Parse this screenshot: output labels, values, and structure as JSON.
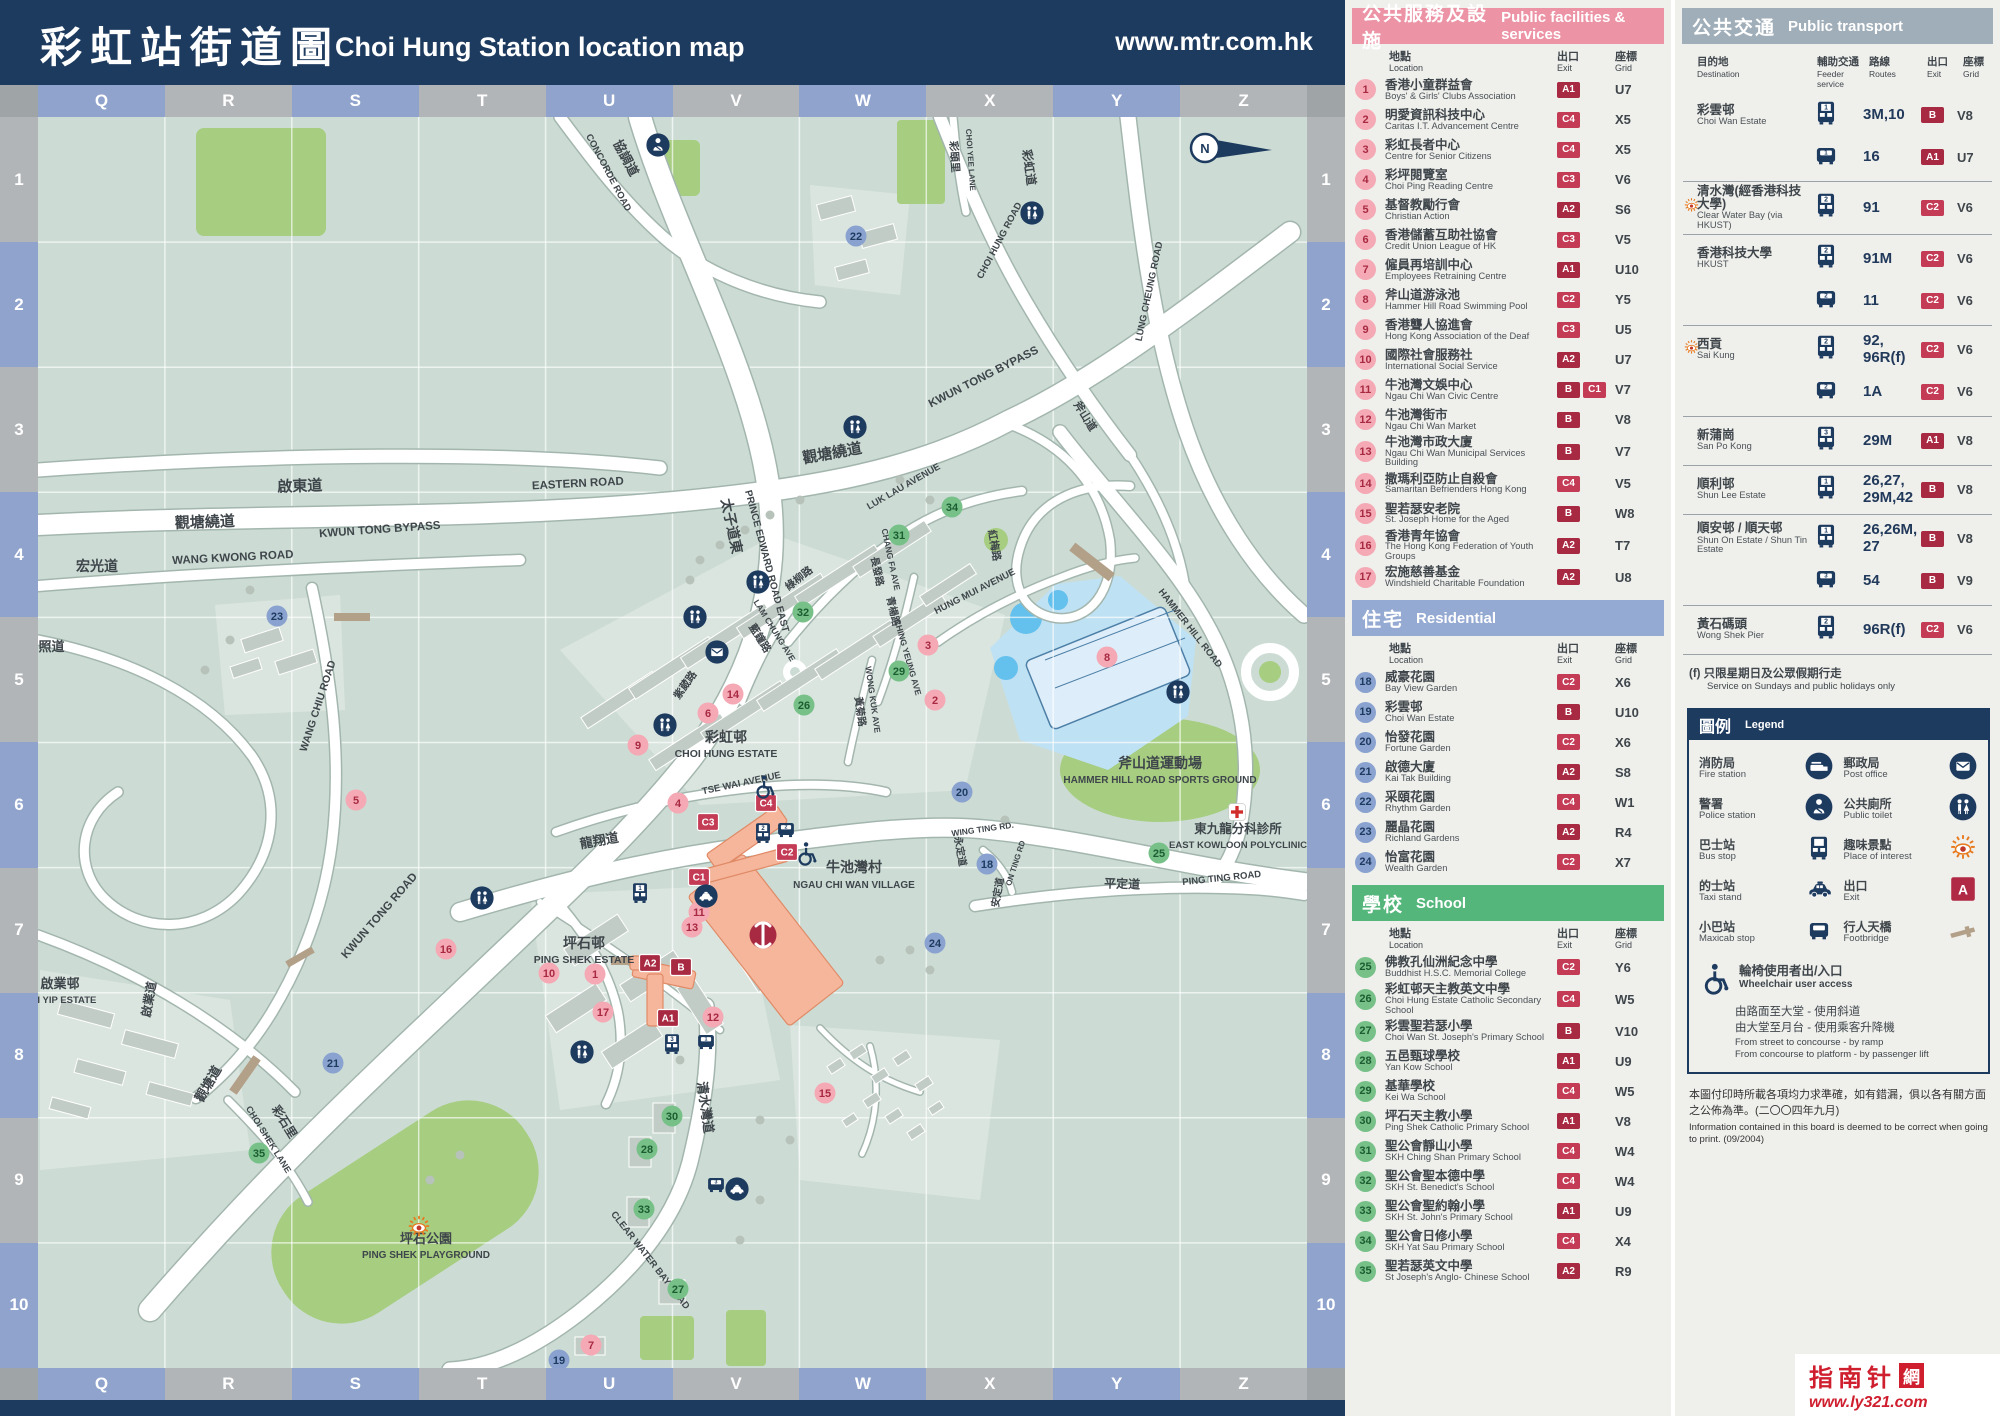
{
  "header": {
    "title_cn": "彩虹站街道圖",
    "title_en": "Choi Hung Station location map",
    "url": "www.mtr.com.hk"
  },
  "grid": {
    "columns": [
      "Q",
      "R",
      "S",
      "T",
      "U",
      "V",
      "W",
      "X",
      "Y",
      "Z"
    ],
    "rows": [
      "1",
      "2",
      "3",
      "4",
      "5",
      "6",
      "7",
      "8",
      "9",
      "10"
    ]
  },
  "colors": {
    "navy": "#1d3a5f",
    "facilities_header": "#ec93a5",
    "residential_header": "#95aad2",
    "school_header": "#55b67c",
    "transport_header": "#a0aeb9",
    "exit_badge": "#a82a42",
    "exit_badge_bright": "#c33b55",
    "marker_pink": "#f4a9b4",
    "marker_blue": "#8aa2cf",
    "marker_green": "#77c189",
    "map_bg": "#ccdcd4",
    "park_green": "#a6cd80",
    "water_blue": "#bfe1f4",
    "station_salmon": "#f5b69c",
    "interest_orange": "#e87a1e"
  },
  "panels": {
    "list_cols": {
      "loc_cn": "地點",
      "loc_en": "Location",
      "exit_cn": "出口",
      "exit_en": "Exit",
      "grid_cn": "座標",
      "grid_en": "Grid"
    },
    "facilities": {
      "title_cn": "公共服務及設施",
      "title_en": "Public facilities & services",
      "items": [
        {
          "num": 1,
          "cn": "香港小童群益會",
          "en": "Boys' & Girls' Clubs Association",
          "exits": [
            "A1"
          ],
          "grid": "U7"
        },
        {
          "num": 2,
          "cn": "明愛資訊科技中心",
          "en": "Caritas I.T. Advancement Centre",
          "exits": [
            "C4"
          ],
          "grid": "X5"
        },
        {
          "num": 3,
          "cn": "彩虹長者中心",
          "en": "Centre for Senior Citizens",
          "exits": [
            "C4"
          ],
          "grid": "X5"
        },
        {
          "num": 4,
          "cn": "彩坪閱覽室",
          "en": "Choi Ping Reading Centre",
          "exits": [
            "C3"
          ],
          "grid": "V6"
        },
        {
          "num": 5,
          "cn": "基督教勵行會",
          "en": "Christian Action",
          "exits": [
            "A2"
          ],
          "grid": "S6"
        },
        {
          "num": 6,
          "cn": "香港儲蓄互助社協會",
          "en": "Credit Union League of HK",
          "exits": [
            "C3"
          ],
          "grid": "V5"
        },
        {
          "num": 7,
          "cn": "僱員再培訓中心",
          "en": "Employees Retraining Centre",
          "exits": [
            "A1"
          ],
          "grid": "U10"
        },
        {
          "num": 8,
          "cn": "斧山道游泳池",
          "en": "Hammer Hill Road Swimming Pool",
          "exits": [
            "C2"
          ],
          "grid": "Y5"
        },
        {
          "num": 9,
          "cn": "香港聾人協進會",
          "en": "Hong Kong Association of the Deaf",
          "exits": [
            "C3"
          ],
          "grid": "U5"
        },
        {
          "num": 10,
          "cn": "國際社會服務社",
          "en": "International Social Service",
          "exits": [
            "A2"
          ],
          "grid": "U7"
        },
        {
          "num": 11,
          "cn": "牛池灣文娛中心",
          "en": "Ngau Chi Wan Civic Centre",
          "exits": [
            "B",
            "C1"
          ],
          "grid": "V7"
        },
        {
          "num": 12,
          "cn": "牛池灣街市",
          "en": "Ngau Chi Wan Market",
          "exits": [
            "B"
          ],
          "grid": "V8"
        },
        {
          "num": 13,
          "cn": "牛池灣市政大廈",
          "en": "Ngau Chi Wan Municipal Services Building",
          "exits": [
            "B"
          ],
          "grid": "V7"
        },
        {
          "num": 14,
          "cn": "撒瑪利亞防止自殺會",
          "en": "Samaritan Befrienders Hong Kong",
          "exits": [
            "C4"
          ],
          "grid": "V5"
        },
        {
          "num": 15,
          "cn": "聖若瑟安老院",
          "en": "St. Joseph Home for the Aged",
          "exits": [
            "B"
          ],
          "grid": "W8"
        },
        {
          "num": 16,
          "cn": "香港青年協會",
          "en": "The Hong Kong Federation of Youth Groups",
          "exits": [
            "A2"
          ],
          "grid": "T7"
        },
        {
          "num": 17,
          "cn": "宏施慈善基金",
          "en": "Windshield Charitable Foundation",
          "exits": [
            "A2"
          ],
          "grid": "U8"
        }
      ]
    },
    "residential": {
      "title_cn": "住宅",
      "title_en": "Residential",
      "items": [
        {
          "num": 18,
          "cn": "威豪花園",
          "en": "Bay View Garden",
          "exits": [
            "C2"
          ],
          "grid": "X6"
        },
        {
          "num": 19,
          "cn": "彩雲邨",
          "en": "Choi Wan Estate",
          "exits": [
            "B"
          ],
          "grid": "U10"
        },
        {
          "num": 20,
          "cn": "怡發花園",
          "en": "Fortune Garden",
          "exits": [
            "C2"
          ],
          "grid": "X6"
        },
        {
          "num": 21,
          "cn": "啟德大廈",
          "en": "Kai Tak Building",
          "exits": [
            "A2"
          ],
          "grid": "S8"
        },
        {
          "num": 22,
          "cn": "采頤花園",
          "en": "Rhythm Garden",
          "exits": [
            "C4"
          ],
          "grid": "W1"
        },
        {
          "num": 23,
          "cn": "麗晶花園",
          "en": "Richland Gardens",
          "exits": [
            "A2"
          ],
          "grid": "R4"
        },
        {
          "num": 24,
          "cn": "怡富花園",
          "en": "Wealth Garden",
          "exits": [
            "C2"
          ],
          "grid": "X7"
        }
      ]
    },
    "school": {
      "title_cn": "學校",
      "title_en": "School",
      "items": [
        {
          "num": 25,
          "cn": "佛教孔仙洲紀念中學",
          "en": "Buddhist H.S.C. Memorial College",
          "exits": [
            "C2"
          ],
          "grid": "Y6"
        },
        {
          "num": 26,
          "cn": "彩虹邨天主教英文中學",
          "en": "Choi Hung Estate Catholic Secondary School",
          "exits": [
            "C4"
          ],
          "grid": "W5"
        },
        {
          "num": 27,
          "cn": "彩雲聖若瑟小學",
          "en": "Choi Wan St. Joseph's Primary School",
          "exits": [
            "B"
          ],
          "grid": "V10"
        },
        {
          "num": 28,
          "cn": "五邑甄球學校",
          "en": "Yan Kow School",
          "exits": [
            "A1"
          ],
          "grid": "U9"
        },
        {
          "num": 29,
          "cn": "基華學校",
          "en": "Kei Wa School",
          "exits": [
            "C4"
          ],
          "grid": "W5"
        },
        {
          "num": 30,
          "cn": "坪石天主教小學",
          "en": "Ping Shek Catholic Primary School",
          "exits": [
            "A1"
          ],
          "grid": "V8"
        },
        {
          "num": 31,
          "cn": "聖公會靜山小學",
          "en": "SKH Ching Shan Primary School",
          "exits": [
            "C4"
          ],
          "grid": "W4"
        },
        {
          "num": 32,
          "cn": "聖公會聖本德中學",
          "en": "SKH St. Benedict's School",
          "exits": [
            "C4"
          ],
          "grid": "W4"
        },
        {
          "num": 33,
          "cn": "聖公會聖約翰小學",
          "en": "SKH St. John's Primary School",
          "exits": [
            "A1"
          ],
          "grid": "U9"
        },
        {
          "num": 34,
          "cn": "聖公會日修小學",
          "en": "SKH Yat Sau Primary School",
          "exits": [
            "C4"
          ],
          "grid": "X4"
        },
        {
          "num": 35,
          "cn": "聖若瑟英文中學",
          "en": "St Joseph's Anglo- Chinese School",
          "exits": [
            "A2"
          ],
          "grid": "R9"
        }
      ]
    },
    "transport": {
      "title_cn": "公共交通",
      "title_en": "Public transport",
      "cols": {
        "dest_cn": "目的地",
        "dest_en": "Destination",
        "feeder_cn": "輔助交通",
        "feeder_en": "Feeder service",
        "routes_cn": "路線",
        "routes_en": "Routes",
        "exit_cn": "出口",
        "exit_en": "Exit",
        "grid_cn": "座標",
        "grid_en": "Grid"
      },
      "groups": [
        {
          "cn": "彩雲邨",
          "en": "Choi Wan Estate",
          "interest": false,
          "rows": [
            {
              "veh": "bus",
              "stop": "1",
              "routes": "3M,10",
              "exit": "B",
              "grid": "V8"
            },
            {
              "veh": "minibus",
              "stop": "1",
              "routes": "16",
              "exit": "A1",
              "grid": "U7"
            }
          ]
        },
        {
          "cn": "清水灣(經香港科技大學)",
          "en": "Clear Water Bay (via HKUST)",
          "interest": true,
          "rows": [
            {
              "veh": "bus",
              "stop": "2",
              "routes": "91",
              "exit": "C2",
              "grid": "V6"
            }
          ]
        },
        {
          "cn": "香港科技大學",
          "en": "HKUST",
          "interest": false,
          "rows": [
            {
              "veh": "bus",
              "stop": "2",
              "routes": "91M",
              "exit": "C2",
              "grid": "V6"
            },
            {
              "veh": "minibus",
              "stop": "2",
              "routes": "11",
              "exit": "C2",
              "grid": "V6"
            }
          ]
        },
        {
          "cn": "西貢",
          "en": "Sai Kung",
          "interest": true,
          "rows": [
            {
              "veh": "bus",
              "stop": "2",
              "routes": "92, 96R(f)",
              "exit": "C2",
              "grid": "V6"
            },
            {
              "veh": "minibus",
              "stop": "2",
              "routes": "1A",
              "exit": "C2",
              "grid": "V6"
            }
          ]
        },
        {
          "cn": "新蒲崗",
          "en": "San Po Kong",
          "interest": false,
          "rows": [
            {
              "veh": "bus",
              "stop": "3",
              "routes": "29M",
              "exit": "A1",
              "grid": "V8"
            }
          ]
        },
        {
          "cn": "順利邨",
          "en": "Shun Lee Estate",
          "interest": false,
          "rows": [
            {
              "veh": "bus",
              "stop": "1",
              "routes": "26,27,\n29M,42",
              "exit": "B",
              "grid": "V8"
            }
          ]
        },
        {
          "cn": "順安邨 / 順天邨",
          "en": "Shun On Estate / Shun Tin Estate",
          "interest": false,
          "rows": [
            {
              "veh": "bus",
              "stop": "1",
              "routes": "26,26M,\n27",
              "exit": "B",
              "grid": "V8"
            },
            {
              "veh": "minibus",
              "stop": "3",
              "routes": "54",
              "exit": "B",
              "grid": "V9"
            }
          ]
        },
        {
          "cn": "黃石碼頭",
          "en": "Wong Shek Pier",
          "interest": false,
          "rows": [
            {
              "veh": "bus",
              "stop": "2",
              "routes": "96R(f)",
              "exit": "C2",
              "grid": "V6"
            }
          ]
        }
      ],
      "footnote_cn": "(f) 只限星期日及公眾假期行走",
      "footnote_en": "Service on Sundays and public holidays only"
    },
    "legend": {
      "title_cn": "圖例",
      "title_en": "Legend",
      "items": [
        {
          "icon": "fire-station",
          "cn": "消防局",
          "en": "Fire station"
        },
        {
          "icon": "police-station",
          "cn": "警署",
          "en": "Police station"
        },
        {
          "icon": "bus-stop",
          "cn": "巴士站",
          "en": "Bus stop"
        },
        {
          "icon": "taxi-stand",
          "cn": "的士站",
          "en": "Taxi stand"
        },
        {
          "icon": "maxicab-stop",
          "cn": "小巴站",
          "en": "Maxicab stop"
        },
        {
          "icon": "post-office",
          "cn": "郵政局",
          "en": "Post office"
        },
        {
          "icon": "public-toilet",
          "cn": "公共廁所",
          "en": "Public toilet"
        },
        {
          "icon": "place-of-interest",
          "cn": "趣味景點",
          "en": "Place of interest"
        },
        {
          "icon": "exit",
          "cn": "出口",
          "en": "Exit"
        },
        {
          "icon": "footbridge",
          "cn": "行人天橋",
          "en": "Footbridge"
        }
      ],
      "wheelchair": {
        "cn": "輪椅使用者出/入口",
        "en": "Wheelchair user access",
        "lines_cn": [
          "由路面至大堂 - 使用斜道",
          "由大堂至月台 - 使用乘客升降機"
        ],
        "lines_en": [
          "From street to concourse - by ramp",
          "From concourse to platform - by passenger lift"
        ]
      }
    },
    "note": {
      "cn": "本圖付印時所載各項均力求準確，如有錯漏，俱以各有關方面之公佈為準。(二〇〇四年九月)",
      "en": "Information contained in this board is deemed to be correct when going to print. (09/2004)"
    },
    "logo": {
      "text": "指南针",
      "seal": "網",
      "url": "www.ly321.com"
    }
  },
  "map": {
    "compass": "N",
    "exits": [
      "A1",
      "A2",
      "B",
      "C1",
      "C2",
      "C3",
      "C4"
    ],
    "labels": {
      "concorde_cn": "協調道",
      "concorde_en": "CONCORDE ROAD",
      "prince_edward_cn": "太子道東",
      "prince_edward_en": "PRINCE EDWARD ROAD EAST",
      "eastern_cn": "啟東道",
      "eastern_en": "EASTERN ROAD",
      "ktb_cn": "觀塘繞道",
      "ktb_en": "KWUN TONG BYPASS",
      "wang_kwong_cn": "宏光道",
      "wang_kwong_en": "WANG KWONG ROAD",
      "wang_chiu_cn": "宏照道",
      "wang_chiu_en": "WANG CHIU ROAD",
      "kwun_tong_rd_cn": "觀塘道",
      "kwun_tong_rd_en": "KWUN TONG ROAD",
      "kai_yip_cn": "啟業邨",
      "kai_yip_en": "KAI YIP ESTATE",
      "kai_yip_rd_cn": "啟業道",
      "choi_shek_cn": "彩石里",
      "choi_shek_en": "CHOI SHEK LANE",
      "ping_shek_cn": "坪石邨",
      "ping_shek_en": "PING SHEK ESTATE",
      "playground_cn": "坪石公園",
      "playground_en": "PING SHEK PLAYGROUND",
      "cwb_cn": "清水灣道",
      "cwb_en": "CLEAR WATER BAY ROAD",
      "che_cn": "彩虹邨",
      "che_en": "CHOI HUNG ESTATE",
      "ncw_cn": "牛池灣村",
      "ncw_en": "NGAU CHI WAN VILLAGE",
      "tse_wai_en": "TSE WAI AVENUE",
      "lam_chung_cn": "藍鐘路",
      "lam_chung_en": "LAM CHUNG AVE",
      "luk_lau_rd_cn": "綠柳路",
      "luk_lau_en": "LUK LAU AVENUE",
      "hung_mui_cn": "紅梅路",
      "hung_mui_en": "HUNG MUI AVENUE",
      "chang_fa_cn": "長發路",
      "chang_fa_en": "CHANG FA AVE",
      "ching_yeung_cn": "青楊路",
      "ching_yeung_en": "CHING YEUNG AVE",
      "wong_kuk_cn": "黃菊路",
      "wong_kuk_en": "WONG KUK AVE",
      "tsz_wai_cn": "紫葳路",
      "lung_cheung_cn": "龍翔道",
      "lung_cheung_en": "LUNG CHEUNG ROAD",
      "choi_hung_rd_cn": "彩虹道",
      "choi_hung_rd_en": "CHOI HUNG ROAD",
      "choi_yee_cn": "彩頤里",
      "choi_yee_en": "CHOI YEE LANE",
      "hammer_cn": "斧山道",
      "hammer_en": "HAMMER HILL ROAD",
      "sports_cn": "斧山道運動場",
      "sports_en": "HAMMER HILL ROAD SPORTS GROUND",
      "poly_cn": "東九龍分科診所",
      "poly_en": "EAST KOWLOON POLYCLINIC",
      "ping_ting_cn": "平定道",
      "ping_ting_en": "PING TING ROAD",
      "wing_ting_cn": "永定道",
      "wing_ting_en": "WING TING RD.",
      "on_ting_cn": "安定道",
      "on_ting_en": "ON TING RD"
    }
  }
}
